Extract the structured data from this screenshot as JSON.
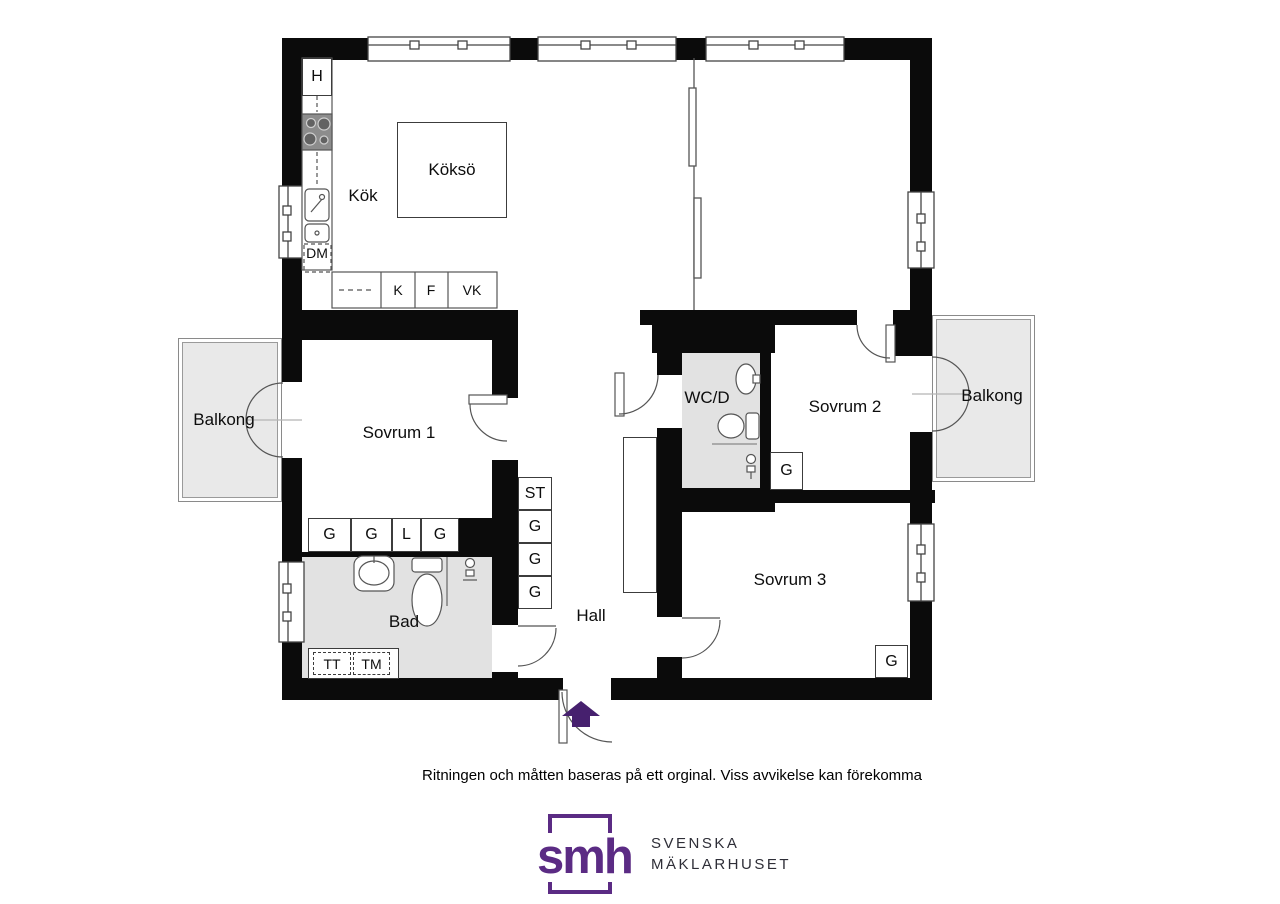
{
  "floorplan": {
    "rooms": {
      "kok": "Kök",
      "kokso": "Köksö",
      "sovrum1": "Sovrum 1",
      "sovrum2": "Sovrum 2",
      "sovrum3": "Sovrum 3",
      "wcd": "WC/D",
      "bad": "Bad",
      "hall": "Hall",
      "balkong_left": "Balkong",
      "balkong_right": "Balkong"
    },
    "kitchen": {
      "hood": "H",
      "dishwasher": "DM",
      "appliance_row": [
        "K",
        "F",
        "VK"
      ]
    },
    "closets": {
      "sovrum1_row": [
        "G",
        "G",
        "L",
        "G"
      ],
      "hall_column": [
        "ST",
        "G",
        "G",
        "G"
      ],
      "wcd_closet": "G",
      "sovrum3_closet": "G"
    },
    "laundry": {
      "dryer": "TT",
      "washer": "TM"
    },
    "colors": {
      "wall": "#0b0b0b",
      "wet_room_floor": "#e2e2e2",
      "balcony_floor": "#e9e9e9",
      "entrance_arrow": "#46206e",
      "brand_purple": "#5b2b84"
    }
  },
  "footer": {
    "disclaimer": "Ritningen och måtten baseras på ett orginal. Viss avvikelse kan förekomma",
    "logo": {
      "monogram": "smh",
      "line1": "SVENSKA",
      "line2": "MÄKLARHUSET"
    }
  }
}
